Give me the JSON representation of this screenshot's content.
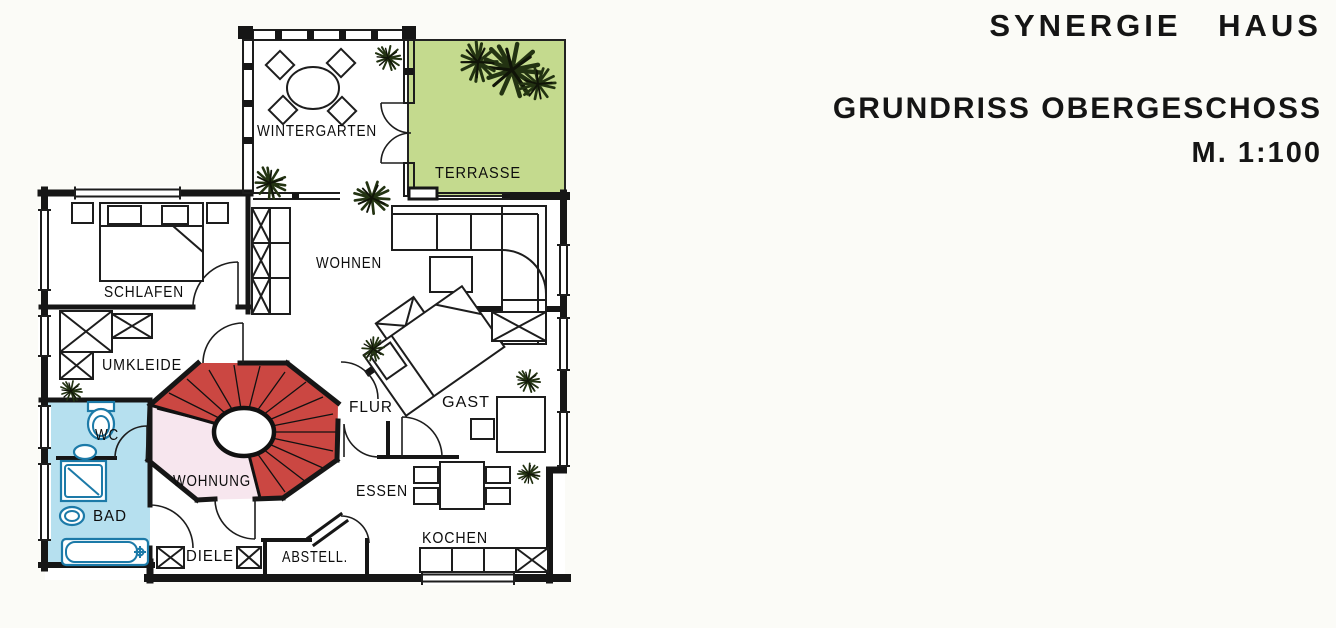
{
  "header": {
    "project": "SYNERGIE HAUS",
    "drawing": "GRUNDRISS OBERGESCHOSS",
    "scale": "M. 1:100"
  },
  "rooms": {
    "wintergarten": "WINTERGARTEN",
    "terrasse": "TERRASSE",
    "wohnen": "WOHNEN",
    "schlafen": "SCHLAFEN",
    "umkleide": "UMKLEIDE",
    "wc": "WC",
    "bad": "BAD",
    "wohnung": "WOHNUNG",
    "flur": "FLUR",
    "gast": "GAST",
    "essen": "ESSEN",
    "kochen": "KOCHEN",
    "diele": "DIELE",
    "abstell": "ABSTELL."
  },
  "colors": {
    "terrace_green": "#c4da8e",
    "bath_blue": "#b6e0ef",
    "stair_red": "#cb4742",
    "hall_pink": "#f7e6ee",
    "plant_green": "#233312",
    "ink": "#161616",
    "paper": "#fbfbf7"
  }
}
